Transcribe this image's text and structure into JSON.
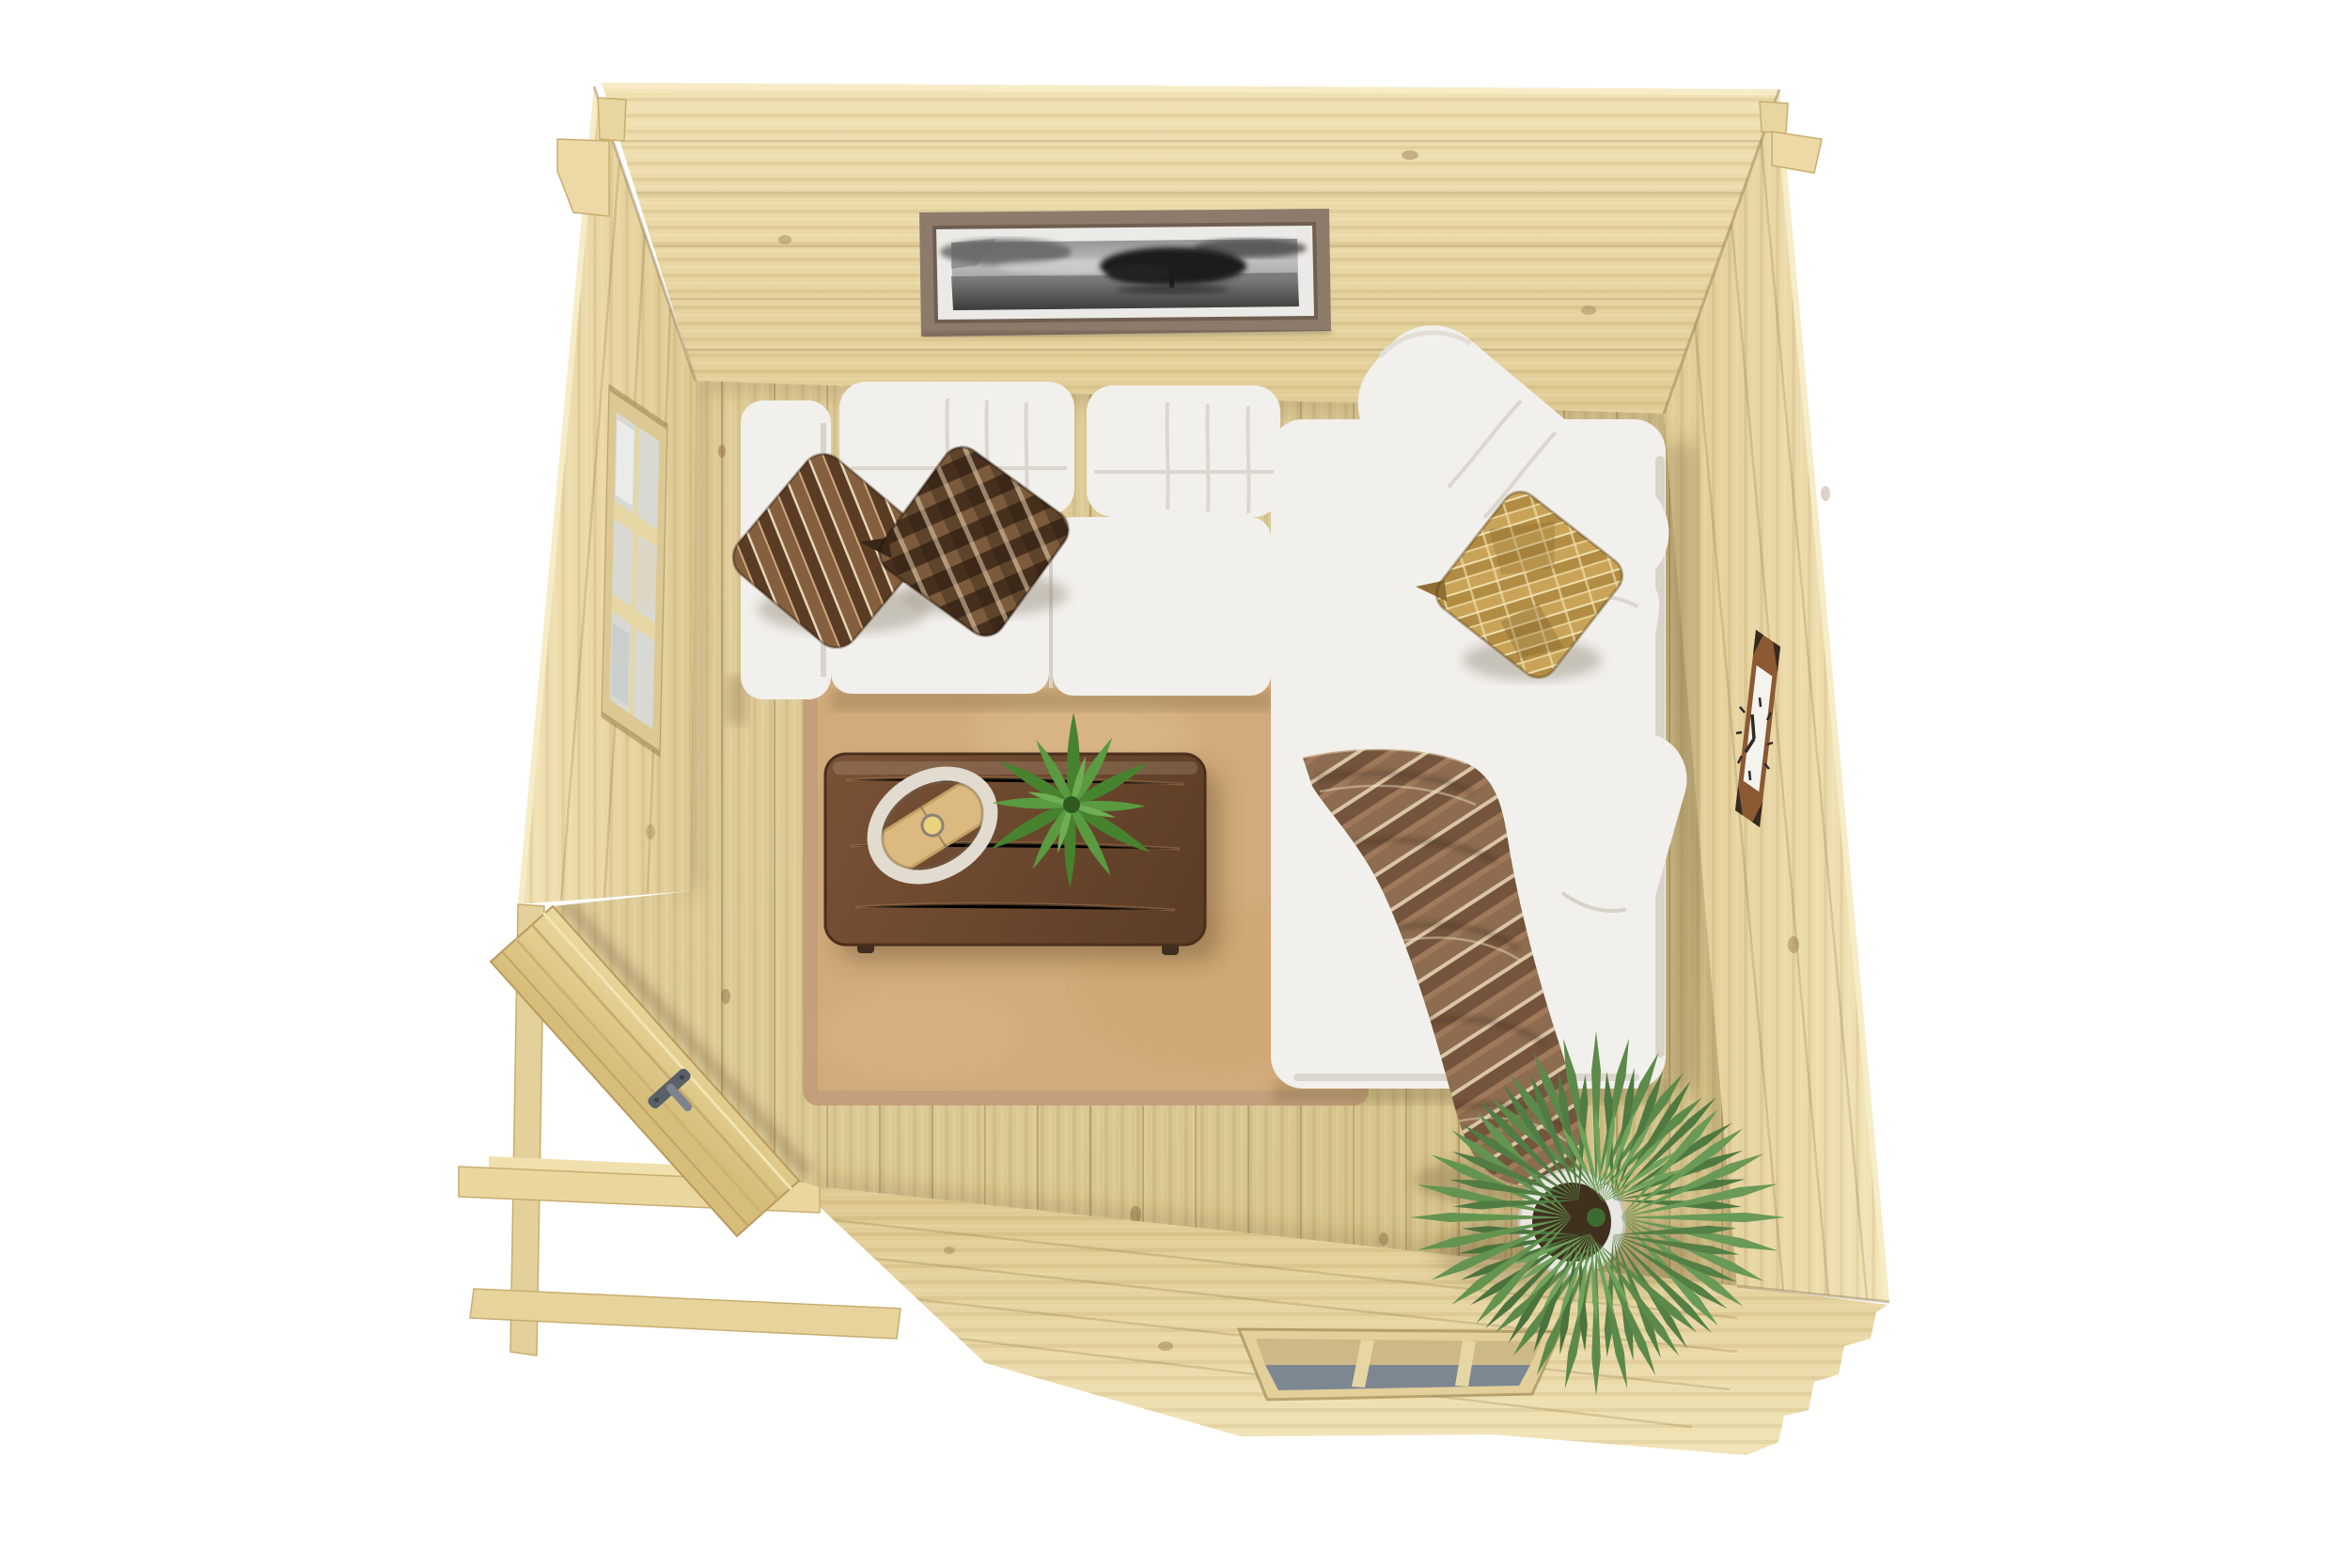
{
  "scene": {
    "type": "3d-render",
    "view": "top-down cutaway",
    "background": "#ffffff",
    "description": "Top-down cutaway 3D render of a small log-cabin garden room: white L-shaped sectional sofa with brown and gold cushions and a striped throw, walnut coffee table with ring lamp and fern, tan rug over a pine plank floor, fan palm in a white pot, panoramic black-and-white wall art, square wooden wall clock, two wooden windows and an open corner door."
  },
  "palette": {
    "background": "#ffffff",
    "wall": "#e9d8a4",
    "wallLight": "#f5ebc3",
    "wallSeam": "#9c7c44",
    "floor": "#d9c892",
    "rug": "#d2ab7c",
    "rugBorder": "#c3a07b",
    "sofa": "#f2f0ec",
    "sofaShadow": "#d5d1c9",
    "table": "#6d4a30",
    "blanket": "#84644a",
    "pillowChevron": "#6b4a33",
    "pillowWoven": "#5a3e2a",
    "pillowGold": "#c9a458",
    "fern": "#4d8a35",
    "palm": "#5c8a4a",
    "potWhite": "#e9e7e1",
    "soil": "#40301e",
    "pictureFrame": "#8c7a6b",
    "pictureMat": "#eceae6",
    "clockFrame": "#8b5a33",
    "glassLight": "#d7d9d2",
    "glassDark": "#7d8792",
    "doorWood": "#e7d49b",
    "handle": "#6d747d"
  },
  "objects": [
    {
      "id": "cabin-shell",
      "label": "Log cabin walls seen from above (cutaway)"
    },
    {
      "id": "framed-picture",
      "label": "Panoramic black-and-white framed photo of a lone tree over water"
    },
    {
      "id": "wall-clock",
      "label": "Square wooden wall clock on right wall"
    },
    {
      "id": "left-window",
      "label": "Six-pane wooden window on left wall"
    },
    {
      "id": "bottom-window",
      "label": "Three-pane wooden window on bottom wall"
    },
    {
      "id": "entry-door",
      "label": "Open corner entry door with grey handle"
    },
    {
      "id": "sectional-sofa",
      "label": "White L-shaped sectional sofa with chaise"
    },
    {
      "id": "pillow-chevron",
      "label": "Brown chevron-striped cushion"
    },
    {
      "id": "pillow-woven",
      "label": "Brown woven-pattern cushion"
    },
    {
      "id": "pillow-gold",
      "label": "Gold geometric cushion"
    },
    {
      "id": "throw-blanket",
      "label": "Brown striped throw blanket draped over chaise"
    },
    {
      "id": "coffee-table",
      "label": "Dark walnut coffee table"
    },
    {
      "id": "table-lamp",
      "label": "Oval ring table lamp with wooden base"
    },
    {
      "id": "fern-plant",
      "label": "Green fern on coffee table"
    },
    {
      "id": "palm-plant",
      "label": "Potted fan palm in corner"
    },
    {
      "id": "area-rug",
      "label": "Tan area rug"
    },
    {
      "id": "pine-floor",
      "label": "Pine plank floor"
    },
    {
      "id": "foundation-beams",
      "label": "Exterior foundation beams and corner posts"
    }
  ]
}
